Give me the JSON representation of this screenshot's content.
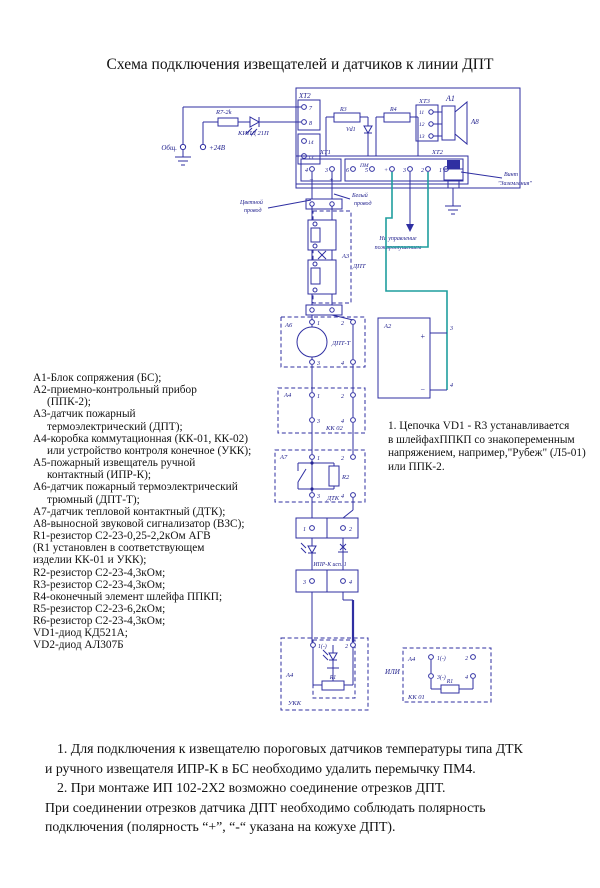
{
  "title": "Схема подключения извещателей и датчиков к линии ДПТ",
  "colors": {
    "line": "#2f2fa2",
    "teal": "#1f9e9e",
    "label": "#1b1b8a"
  },
  "diagram": {
    "labels": {
      "a1": "A1",
      "xt2_left": "XT2",
      "xt2l_terms": [
        "7",
        "8",
        "14",
        "13"
      ],
      "r7": "R7-2k",
      "led": "КИПД 21П",
      "obsh": "Общ.",
      "v24": "+24В",
      "r3": "R3",
      "r4": "R4",
      "vd1": "Vd1",
      "xt3": "XT3",
      "xt3_terms": [
        "11",
        "12",
        "13"
      ],
      "a8": "A8",
      "xt1": "XT1",
      "xt2_bottom": "XT2",
      "pm": "ПМ",
      "xt1_terms": [
        "4",
        "3"
      ],
      "xt1_signs": [
        "−",
        "+"
      ],
      "xt2b_terms": [
        "6",
        "5",
        "+",
        "3",
        "2",
        "1"
      ],
      "vint_line1": "Винт",
      "vint_line2": "\"Заземления\"",
      "wire_color_line1": "Цветной",
      "wire_color_line2": "провод",
      "wire_white_line1": "Белый",
      "wire_white_line2": "провод",
      "upr_line1": "На управление",
      "upr_line2": "пожаротушением",
      "a3": "A3",
      "dpt": "ДПТ",
      "a6": "A6",
      "dptt": "ДПТ-Т",
      "a6_terms": [
        "1",
        "2",
        "3",
        "4"
      ],
      "a2": "A2",
      "a2_plus": "+",
      "a2_minus": "−",
      "a2_terms": [
        "3",
        "4"
      ],
      "a4_kk02": "A4",
      "kk02": "КК 02",
      "kk02_terms": [
        "1",
        "2",
        "3",
        "4"
      ],
      "a7": "A7",
      "r2": "R2",
      "dtk": "ДТК",
      "a7_terms": [
        "1",
        "2",
        "3",
        "4"
      ],
      "ipr": "ИПР-К исп. 1",
      "ipr_terms": [
        "1",
        "2",
        "3",
        "4"
      ],
      "a4_ukk": "A4",
      "ukk": "УКК",
      "r1a": "R1",
      "ukk_terms": [
        "1(-)",
        "2"
      ],
      "ili": "ИЛИ",
      "a4_kk01": "A4",
      "kk01": "КК 01",
      "r1b": "R1",
      "kk01_terms": [
        "1(-)",
        "2",
        "3(-)",
        "4"
      ]
    }
  },
  "legend": {
    "lines": [
      "А1-Блок сопряжения (БС);",
      "А2-приемно-контрольный прибор",
      "(ППК-2);",
      "А3-датчик пожарный",
      "термоэлектрический (ДПТ);",
      "А4-коробка коммутационная (КК-01, КК-02)",
      "или устройство контроля конечное (УКК);",
      "А5-пожарный извещатель ручной",
      "контактный (ИПР-К);",
      "А6-датчик пожарный термоэлектрический",
      "трюмный (ДПТ-Т);",
      "А7-датчик тепловой контактный (ДТК);",
      "А8-выносной звуковой сигнализатор (ВЗС);",
      "R1-резистор С2-23-0,25-2,2кОм АГВ",
      "(R1 установлен в соответствующем",
      "изделии КК-01 и УКК);",
      "R2-резистор С2-23-4,3кОм;",
      "R3-резистор С2-23-4,3кОм;",
      "R4-оконечный элемент шлейфа ППКП;",
      "R5-резистор С2-23-6,2кОм;",
      "R6-резистор С2-23-4,3кОм;",
      "VD1-диод КД521А;",
      "VD2-диод АЛ307Б"
    ]
  },
  "note_right": {
    "lines": [
      "1. Цепочка VD1 - R3 устанавливается",
      "в шлейфахППКП со знакопеременным",
      "напряжением, например,\"Рубеж\" (Л5-01)",
      "или ППК-2."
    ]
  },
  "notes_bottom": {
    "lines": [
      "1. Для подключения к извещателю пороговых датчиков температуры типа ДТК",
      "и ручного извещателя ИПР-К в БС необходимо удалить перемычку ПМ4.",
      "2. При монтаже ИП 102-2Х2 возможно соединение отрезков ДПТ.",
      "При соединении отрезков датчика ДПТ необходимо соблюдать полярность",
      "подключения  (полярность “+”, “-“ указана на кожухе  ДПТ)."
    ]
  }
}
